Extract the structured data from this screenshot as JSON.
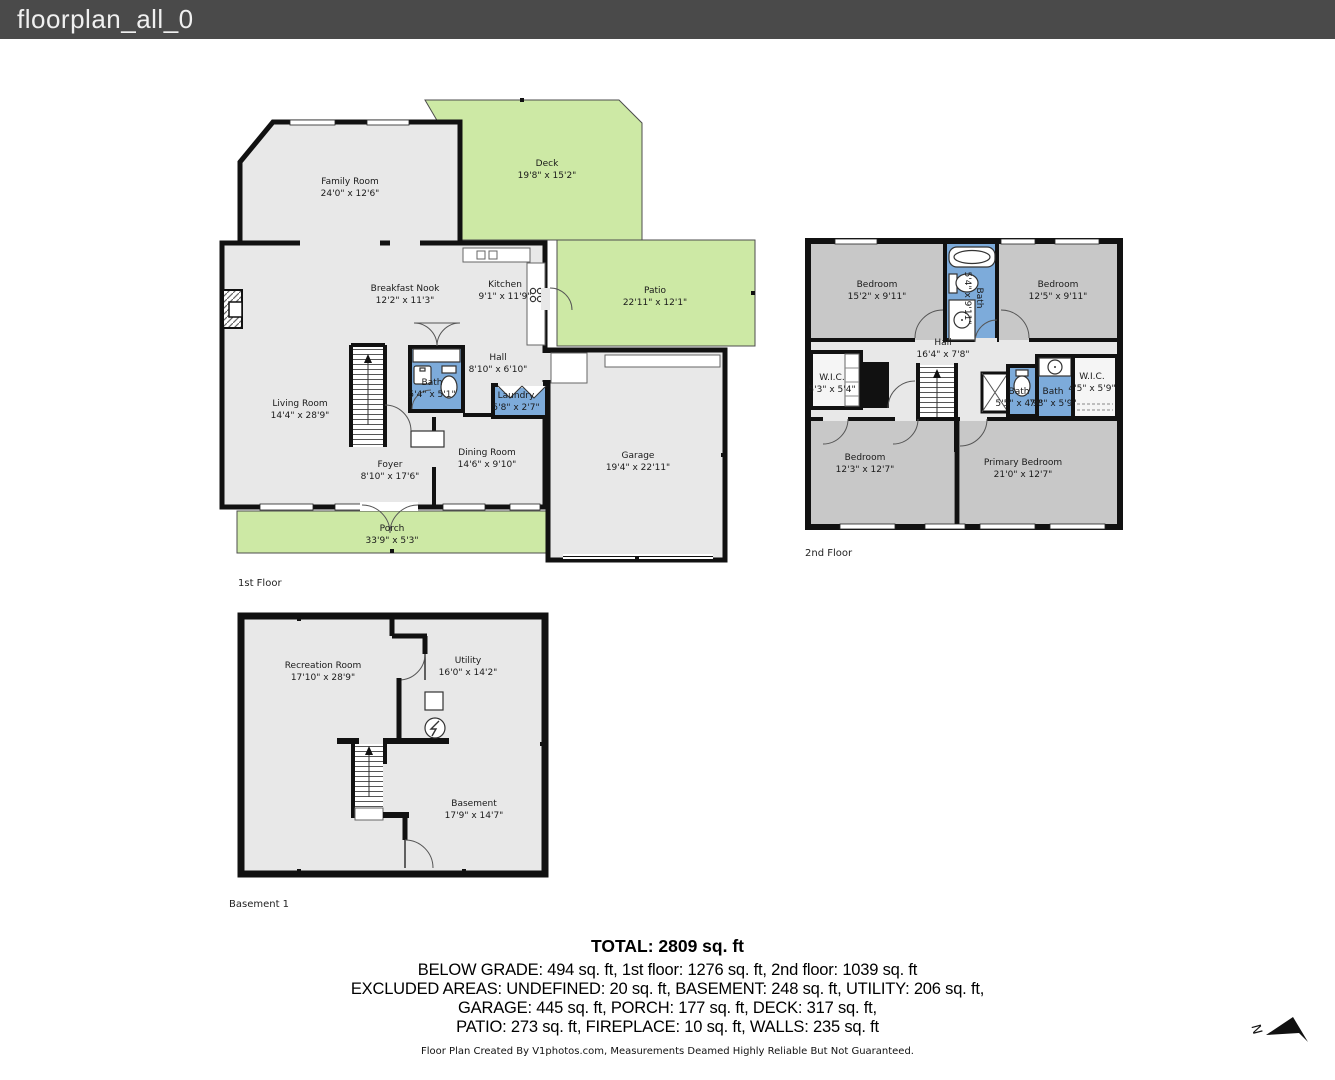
{
  "title": "floorplan_all_0",
  "floor1": {
    "caption": "1st Floor",
    "rooms": {
      "family_room": {
        "name": "Family Room",
        "dims": "24'0\" x 12'6\""
      },
      "deck": {
        "name": "Deck",
        "dims": "19'8\" x 15'2\""
      },
      "patio": {
        "name": "Patio",
        "dims": "22'11\" x 12'1\""
      },
      "breakfast_nook": {
        "name": "Breakfast Nook",
        "dims": "12'2\" x 11'3\""
      },
      "kitchen": {
        "name": "Kitchen",
        "dims": "9'1\" x 11'9\""
      },
      "hall": {
        "name": "Hall",
        "dims": "8'10\" x 6'10\""
      },
      "bath": {
        "name": "Bath",
        "dims": "5'4\" x 5'1\""
      },
      "laundry": {
        "name": "Laundry",
        "dims": "5'8\" x 2'7\""
      },
      "living_room": {
        "name": "Living Room",
        "dims": "14'4\" x 28'9\""
      },
      "dining_room": {
        "name": "Dining Room",
        "dims": "14'6\" x 9'10\""
      },
      "foyer": {
        "name": "Foyer",
        "dims": "8'10\" x 17'6\""
      },
      "garage": {
        "name": "Garage",
        "dims": "19'4\" x 22'11\""
      },
      "porch": {
        "name": "Porch",
        "dims": "33'9\" x 5'3\""
      }
    }
  },
  "floor2": {
    "caption": "2nd Floor",
    "rooms": {
      "bedroom_tl": {
        "name": "Bedroom",
        "dims": "15'2\" x 9'11\""
      },
      "bath_center": {
        "name": "Bath",
        "dims": "5'4\" x 9'11\""
      },
      "bedroom_tr": {
        "name": "Bedroom",
        "dims": "12'5\" x 9'11\""
      },
      "hall": {
        "name": "Hall",
        "dims": "16'4\" x 7'8\""
      },
      "wic_left": {
        "name": "W.I.C.",
        "dims": "5'3\" x 5'4\""
      },
      "bath_small": {
        "name": "Bath",
        "dims": "5'5\" x 4'9\""
      },
      "bath_large": {
        "name": "Bath",
        "dims": "7'8\" x 5'9\""
      },
      "wic_right": {
        "name": "W.I.C.",
        "dims": "4'5\" x 5'9\""
      },
      "bedroom_bl": {
        "name": "Bedroom",
        "dims": "12'3\" x 12'7\""
      },
      "primary_bedroom": {
        "name": "Primary Bedroom",
        "dims": "21'0\" x 12'7\""
      }
    }
  },
  "basement": {
    "caption": "Basement 1",
    "rooms": {
      "recreation_room": {
        "name": "Recreation Room",
        "dims": "17'10\" x 28'9\""
      },
      "utility": {
        "name": "Utility",
        "dims": "16'0\" x 14'2\""
      },
      "basement_room": {
        "name": "Basement",
        "dims": "17'9\" x 14'7\""
      }
    }
  },
  "summary": {
    "total": "TOTAL: 2809 sq. ft",
    "line1": "BELOW GRADE: 494 sq. ft, 1st floor: 1276 sq. ft, 2nd floor: 1039 sq. ft",
    "line2": "EXCLUDED AREAS: UNDEFINED: 20 sq. ft, BASEMENT: 248 sq. ft, UTILITY: 206 sq. ft,",
    "line3": "GARAGE: 445 sq. ft, PORCH: 177 sq. ft, DECK: 317 sq. ft,",
    "line4": "PATIO: 273 sq. ft, FIREPLACE: 10 sq. ft, WALLS: 235 sq. ft"
  },
  "footer": "Floor Plan Created By V1photos.com, Measurements Deamed Highly Reliable But Not Guaranteed.",
  "compass_label": "N",
  "colors": {
    "outdoor_green": "#cde9a5",
    "wet_blue": "#7dabda",
    "room_gray": "#e8e8e8",
    "bedroom_gray": "#c8c8c8",
    "wall": "#111111",
    "titlebar": "#4a4a4a"
  }
}
